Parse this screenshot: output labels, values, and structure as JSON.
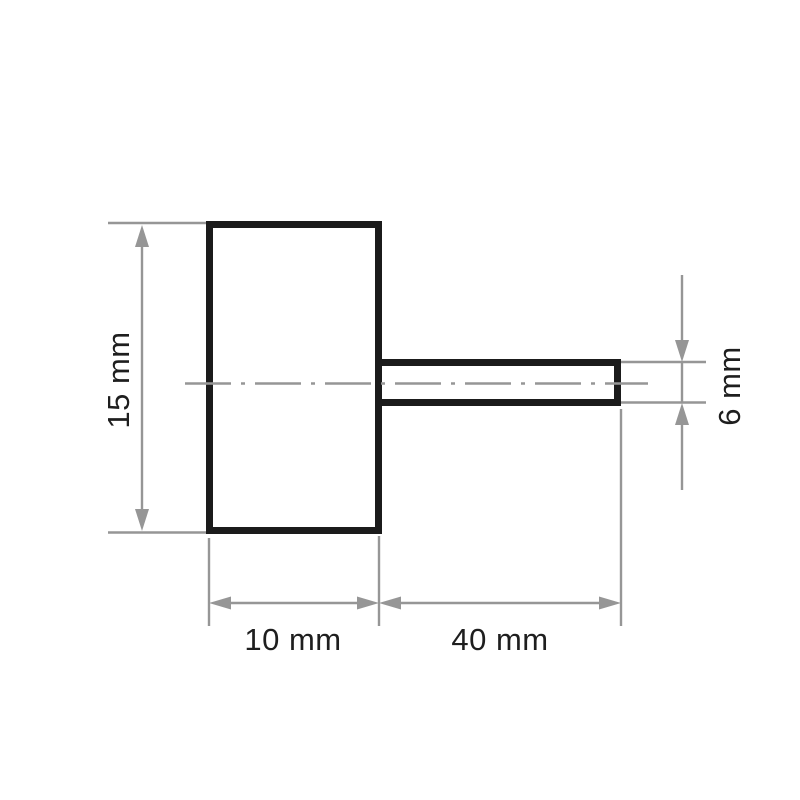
{
  "diagram": {
    "type": "technical-drawing",
    "subject": "flap wheel with spindle shaft, side view",
    "unit": "mm",
    "colors": {
      "outline": "#1b1b1b",
      "dimension": "#969696",
      "text": "#1e1e1e",
      "background": "#ffffff"
    },
    "dimensions": [
      {
        "id": "body-height",
        "label": "15 mm",
        "value": 15,
        "orientation": "vertical"
      },
      {
        "id": "body-width",
        "label": "10 mm",
        "value": 10,
        "orientation": "horizontal"
      },
      {
        "id": "shaft-length",
        "label": "40 mm",
        "value": 40,
        "orientation": "horizontal"
      },
      {
        "id": "shaft-diameter",
        "label": "6 mm",
        "value": 6,
        "orientation": "vertical"
      }
    ]
  }
}
